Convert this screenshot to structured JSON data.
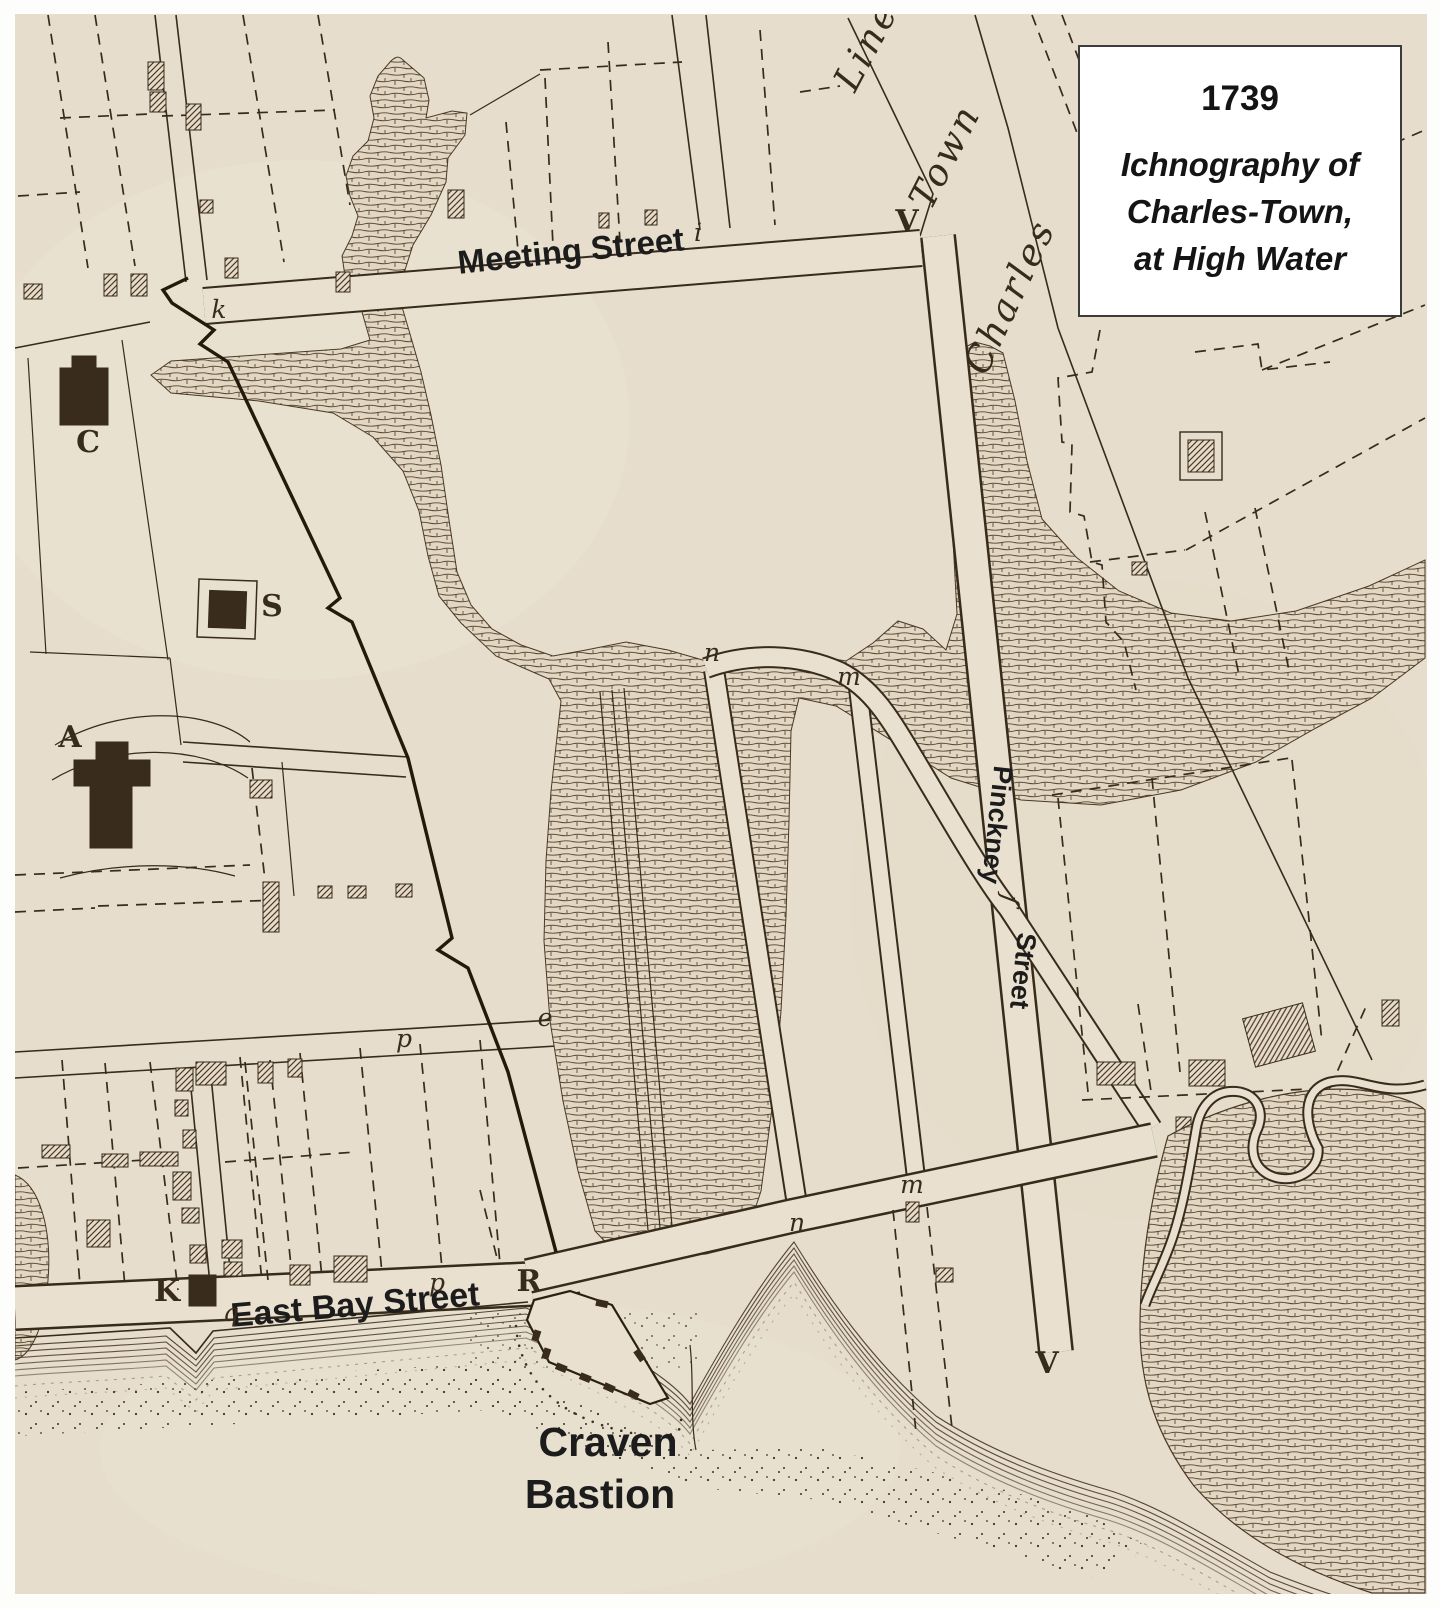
{
  "title_box": {
    "year": "1739",
    "line1": "Ichnography of",
    "line2": "Charles-Town,",
    "line3": "at High Water"
  },
  "street_labels": {
    "meeting": "Meeting Street",
    "east_bay": "East Bay Street",
    "pinckney_1": "Pinckney",
    "pinckney_2": "Street",
    "craven_1": "Craven",
    "craven_2": "Bastion"
  },
  "engraved_labels": {
    "charles": "Charles",
    "town": "Town",
    "line": "Line"
  },
  "map_letters": [
    {
      "ch": "C",
      "x": 88,
      "y": 452,
      "style": "cap"
    },
    {
      "ch": "S",
      "x": 272,
      "y": 616,
      "style": "cap"
    },
    {
      "ch": "A",
      "x": 70,
      "y": 747,
      "style": "cap"
    },
    {
      "ch": "K",
      "x": 167,
      "y": 1301,
      "style": "cap"
    },
    {
      "ch": "R",
      "x": 529,
      "y": 1291,
      "style": "cap"
    },
    {
      "ch": "V",
      "x": 907,
      "y": 231,
      "style": "cap"
    },
    {
      "ch": "V",
      "x": 1047,
      "y": 1373,
      "style": "cap"
    },
    {
      "ch": "k",
      "x": 219,
      "y": 318,
      "style": "ita"
    },
    {
      "ch": "i",
      "x": 698,
      "y": 241,
      "style": "ita"
    },
    {
      "ch": "n",
      "x": 712,
      "y": 661,
      "style": "ita"
    },
    {
      "ch": "m",
      "x": 849,
      "y": 685,
      "style": "ita"
    },
    {
      "ch": "e",
      "x": 545,
      "y": 1026,
      "style": "ita"
    },
    {
      "ch": "p",
      "x": 404,
      "y": 1047,
      "style": "ita"
    },
    {
      "ch": "n",
      "x": 797,
      "y": 1231,
      "style": "ita"
    },
    {
      "ch": "m",
      "x": 912,
      "y": 1193,
      "style": "ita"
    },
    {
      "ch": "q",
      "x": 231,
      "y": 1321,
      "style": "ita"
    },
    {
      "ch": "p",
      "x": 437,
      "y": 1291,
      "style": "ita"
    },
    {
      "ch": "ſ",
      "x": 1002,
      "y": 898,
      "rot": 100,
      "style": "ita"
    }
  ],
  "colors": {
    "paper": "#e9e0d0",
    "paper2": "#e2d8c5",
    "ink": "#372b1b",
    "wall": "#241a0c",
    "label": "#1c1c1c",
    "bdark": "#392c1c",
    "marshbg": "#e2d7c2",
    "marshline": "#5a4732",
    "shore": "#4c3b28",
    "title_bg": "#ffffff"
  }
}
